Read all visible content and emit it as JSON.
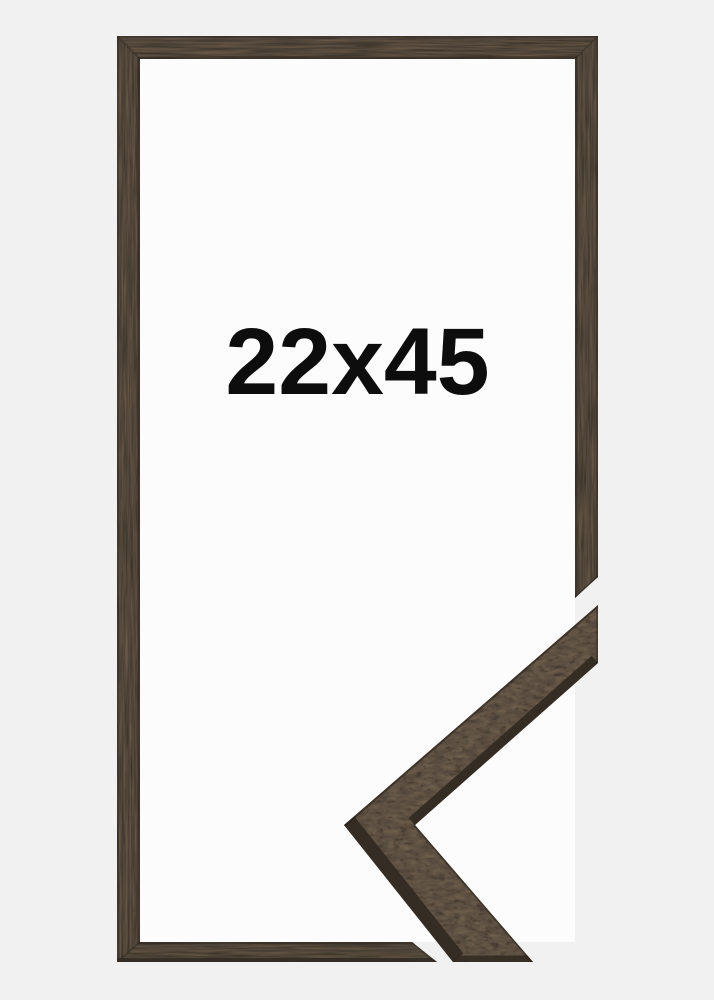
{
  "image": {
    "description": "Product photo of a dark brown wooden picture frame with a magnified mitred corner sample of the moulding at the bottom right",
    "size_label": "22x45"
  },
  "colors": {
    "background": "#f1f1f2",
    "frame-opening": "#fcfcfc",
    "wood-base": "#473e34",
    "wood-mid": "#564a3e",
    "wood-light": "#6b5c4a",
    "wood-dark": "#2f2821",
    "wood-side": "#332b23",
    "label-text": "#0d0d0d"
  }
}
